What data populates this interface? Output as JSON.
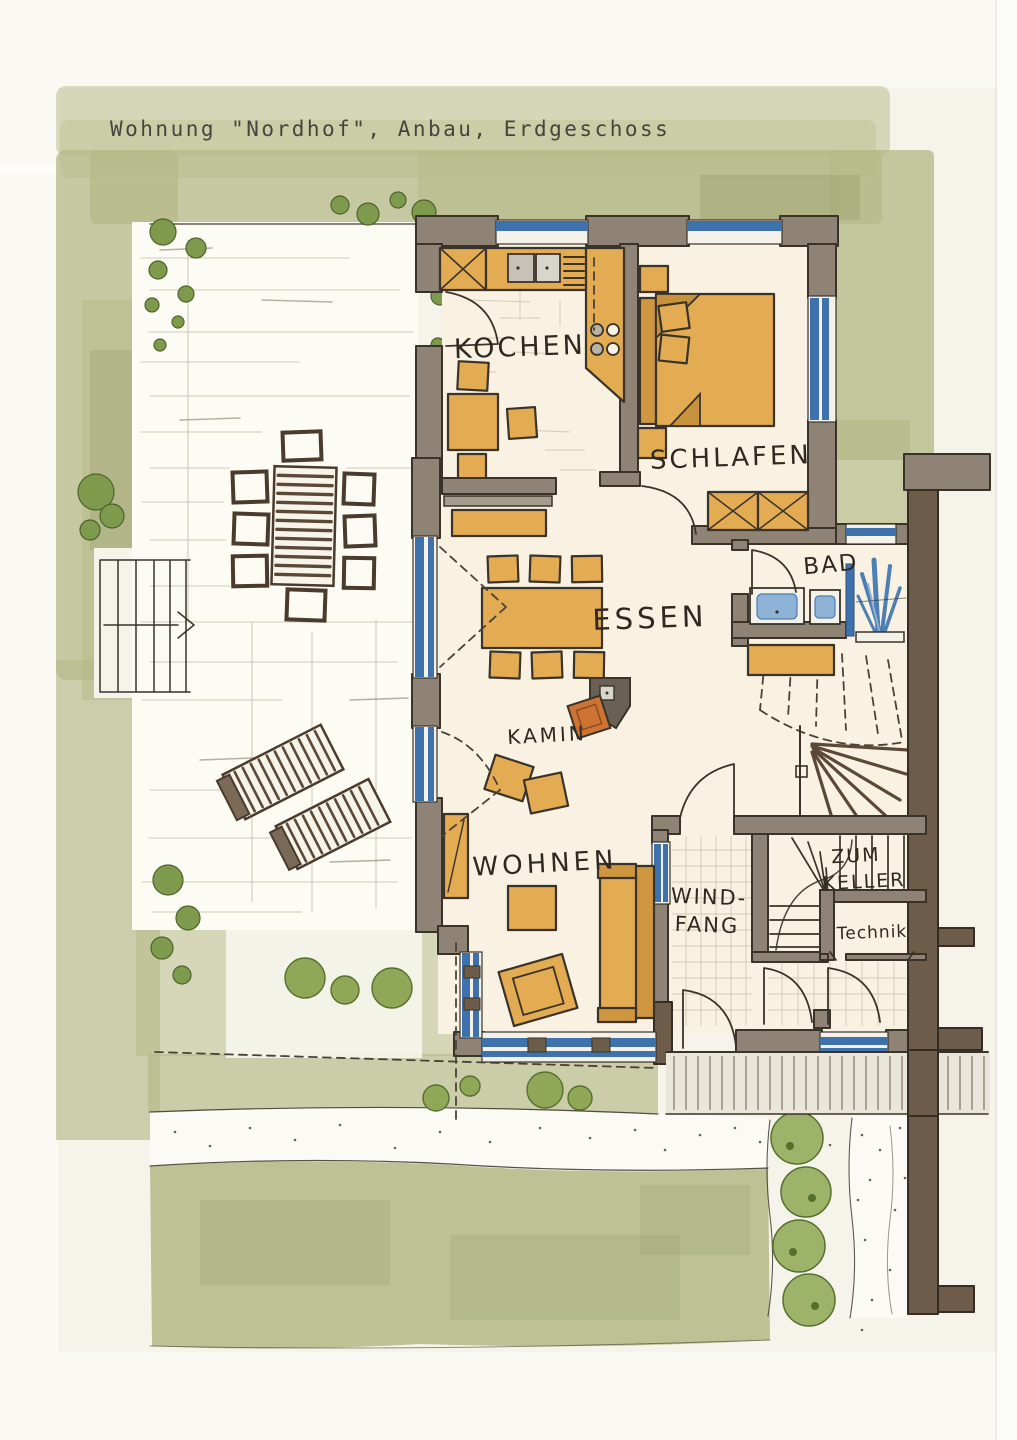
{
  "title": "Wohnung \"Nordhof\", Anbau, Erdgeschoss",
  "plan": {
    "rooms": {
      "kochen": {
        "label": "KOCHEN"
      },
      "schlafen": {
        "label": "SCHLAFEN"
      },
      "essen": {
        "label": "ESSEN"
      },
      "kamin": {
        "label": "KAMIN"
      },
      "wohnen": {
        "label": "WOHNEN"
      },
      "bad": {
        "label": "BAD"
      },
      "windfang": {
        "line1": "WIND-",
        "line2": "FANG"
      },
      "zum_keller": {
        "line1": "ZUM",
        "line2": "KELLER"
      },
      "technik": {
        "label": "Technik"
      }
    }
  },
  "colors": {
    "paper": "#f6f4ea",
    "garden_green": "#b6ba88",
    "shrub_green": "#8fa757",
    "wall_taupe": "#8e8375",
    "wall_dark_brown": "#6e5c4b",
    "window_blue": "#3f72ac",
    "furniture_orange": "#e3ab52",
    "wood_brown": "#5b4836",
    "fire_orange": "#cd7334",
    "ink": "#3a332a"
  }
}
